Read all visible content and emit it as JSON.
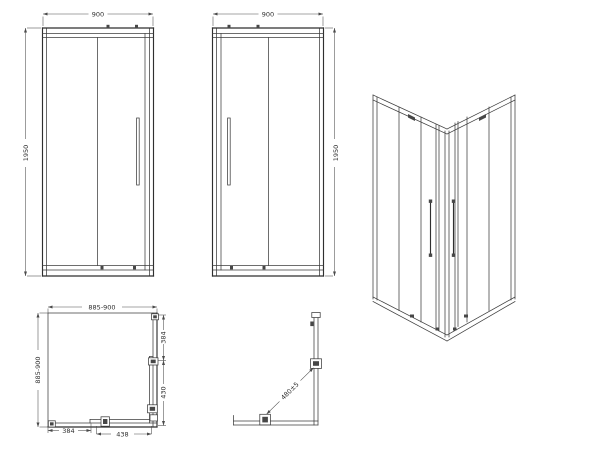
{
  "colors": {
    "background": "#ffffff",
    "line": "#3d3d3d",
    "dimension_line": "#4a4a4a",
    "dimension_text": "#2e2e2e"
  },
  "views": {
    "front_left": {
      "width_dim": "900",
      "height_dim": "1950"
    },
    "front_right": {
      "width_dim": "900",
      "height_dim": "1950"
    },
    "plan": {
      "width_dim": "885-900",
      "depth_dim": "885-900",
      "side_fixed_dim": "384",
      "side_door_dim": "430",
      "front_fixed_dim": "384",
      "front_door_dim": "438"
    },
    "corner_detail": {
      "diagonal_dim": "480±5"
    }
  }
}
